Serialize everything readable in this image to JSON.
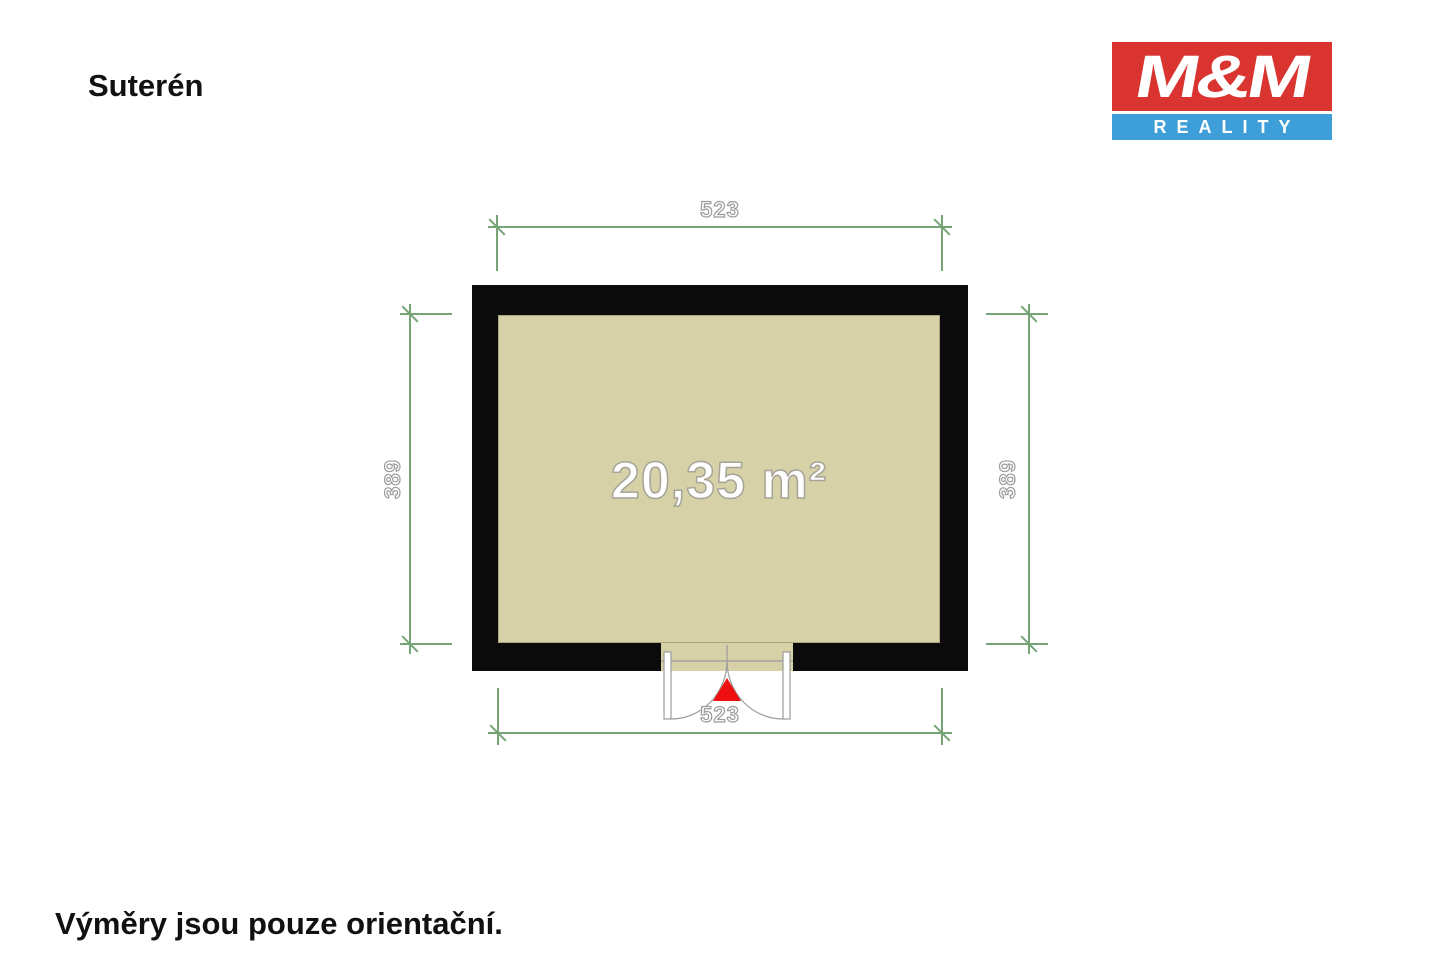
{
  "header": {
    "title": "Suterén"
  },
  "logo": {
    "top_text": "M&M",
    "bottom_text": "REALITY"
  },
  "floorplan": {
    "room": {
      "area_label": "20,35 m²"
    },
    "dimensions": {
      "top": "523",
      "bottom": "523",
      "left": "389",
      "right": "389"
    }
  },
  "footer": {
    "disclaimer": "Výměry jsou pouze orientační."
  },
  "theme": {
    "wall": "#0b0b0b",
    "floor": "#d7d1a7",
    "dimline": "#76a476",
    "outline": "#9b9b9b",
    "marker": "#ee1010",
    "logored": "#d93430",
    "logoblue": "#3d9ed8",
    "ink": "#111111",
    "floorborder": "#aba67f"
  }
}
